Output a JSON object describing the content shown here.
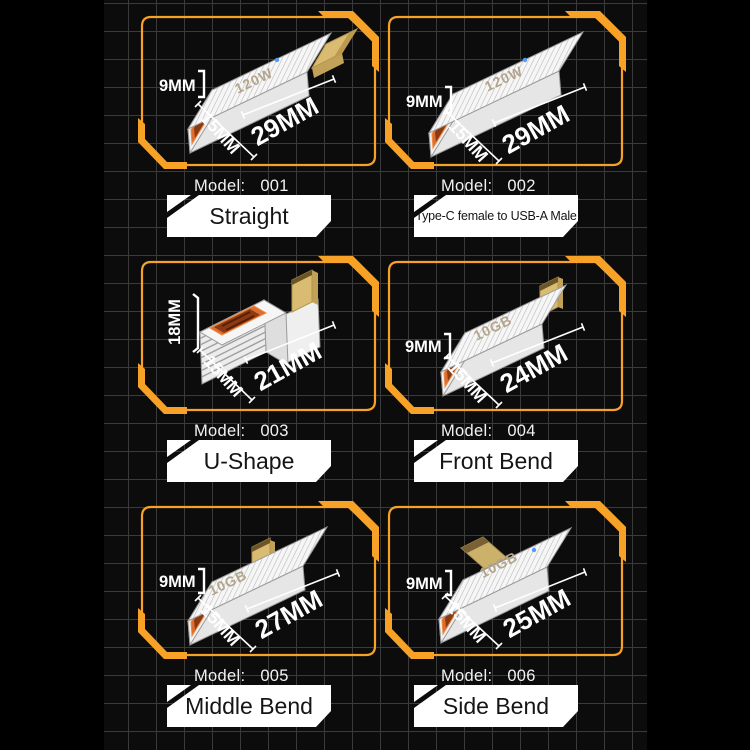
{
  "panels": [
    {
      "model_label": "Model:",
      "model_number": "001",
      "name": "Straight",
      "dim_height": "9MM",
      "dim_width": "15MM",
      "dim_length": "29MM",
      "body_text": "120W"
    },
    {
      "model_label": "Model:",
      "model_number": "002",
      "name": "Type-C female to USB-A Male",
      "dim_height": "9MM",
      "dim_width": "15MM",
      "dim_length": "29MM",
      "body_text": "120W"
    },
    {
      "model_label": "Model:",
      "model_number": "003",
      "name": "U-Shape",
      "dim_height": "18MM",
      "dim_width": "15MM",
      "dim_length": "21MM",
      "body_text": ""
    },
    {
      "model_label": "Model:",
      "model_number": "004",
      "name": "Front Bend",
      "dim_height": "9MM",
      "dim_width": "15MM",
      "dim_length": "24MM",
      "body_text": "10GB"
    },
    {
      "model_label": "Model:",
      "model_number": "005",
      "name": "Middle Bend",
      "dim_height": "9MM",
      "dim_width": "15MM",
      "dim_length": "27MM",
      "body_text": "10GB"
    },
    {
      "model_label": "Model:",
      "model_number": "006",
      "name": "Side Bend",
      "dim_height": "9MM",
      "dim_width": "15MM",
      "dim_length": "25MM",
      "body_text": "10GB"
    }
  ],
  "colors": {
    "accent_orange": "#F7A227",
    "grid_line": "#3B3B3B",
    "panel_bg": "#0C0C0C",
    "page_bg": "#000000",
    "port_orange": "#DB6E30",
    "plug_gold": "#D9BC72",
    "led_blue": "#4F9BFF",
    "label_bg": "#FFFFFF",
    "text_white": "#FFFFFF"
  }
}
